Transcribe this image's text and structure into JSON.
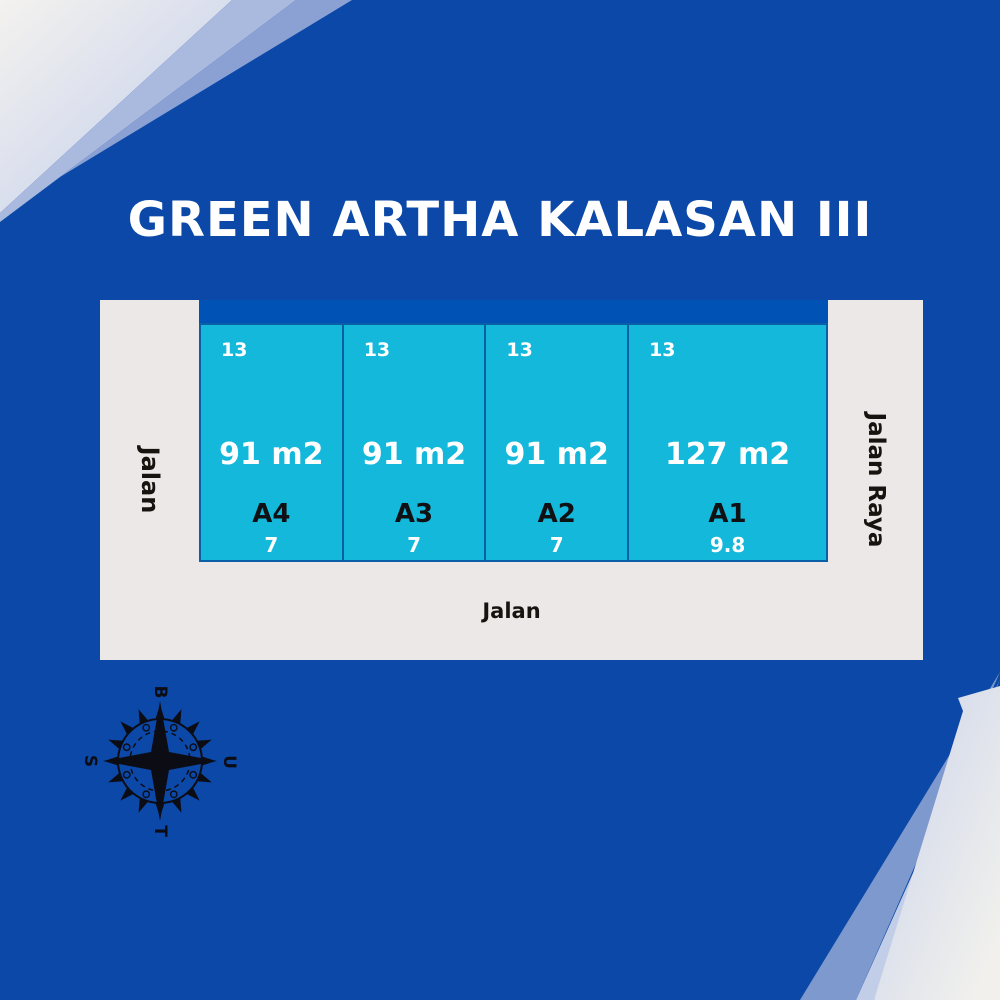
{
  "title": "GREEN ARTHA KALASAN III",
  "site_plan": {
    "roads": {
      "left_label": "Jalan",
      "right_label": "Jalan Raya",
      "bottom_label": "Jalan"
    },
    "plots": [
      {
        "id": "A4",
        "area_label": "91 m2",
        "depth_label": "13",
        "width_label": "7"
      },
      {
        "id": "A3",
        "area_label": "91 m2",
        "depth_label": "13",
        "width_label": "7"
      },
      {
        "id": "A2",
        "area_label": "91 m2",
        "depth_label": "13",
        "width_label": "7"
      },
      {
        "id": "A1",
        "area_label": "127 m2",
        "depth_label": "13",
        "width_label": "9.8"
      }
    ]
  },
  "compass": {
    "top": "B",
    "right": "U",
    "bottom": "T",
    "left": "S"
  },
  "colors": {
    "background": "#0b48a7",
    "setback_strip": "#0052b4",
    "plot_fill": "#13b8da",
    "plot_border": "#0a5fa6",
    "road_fill": "#ebe8e7",
    "title_text": "#ffffff",
    "plot_area_text": "#ffffff",
    "plot_id_text": "#101114",
    "road_text": "#17130f",
    "compass_ink": "#0c0c14",
    "corner_lightest": "#f2f0ed",
    "corner_steel": "#aab9de",
    "corner_deep": "#7e99ce"
  }
}
